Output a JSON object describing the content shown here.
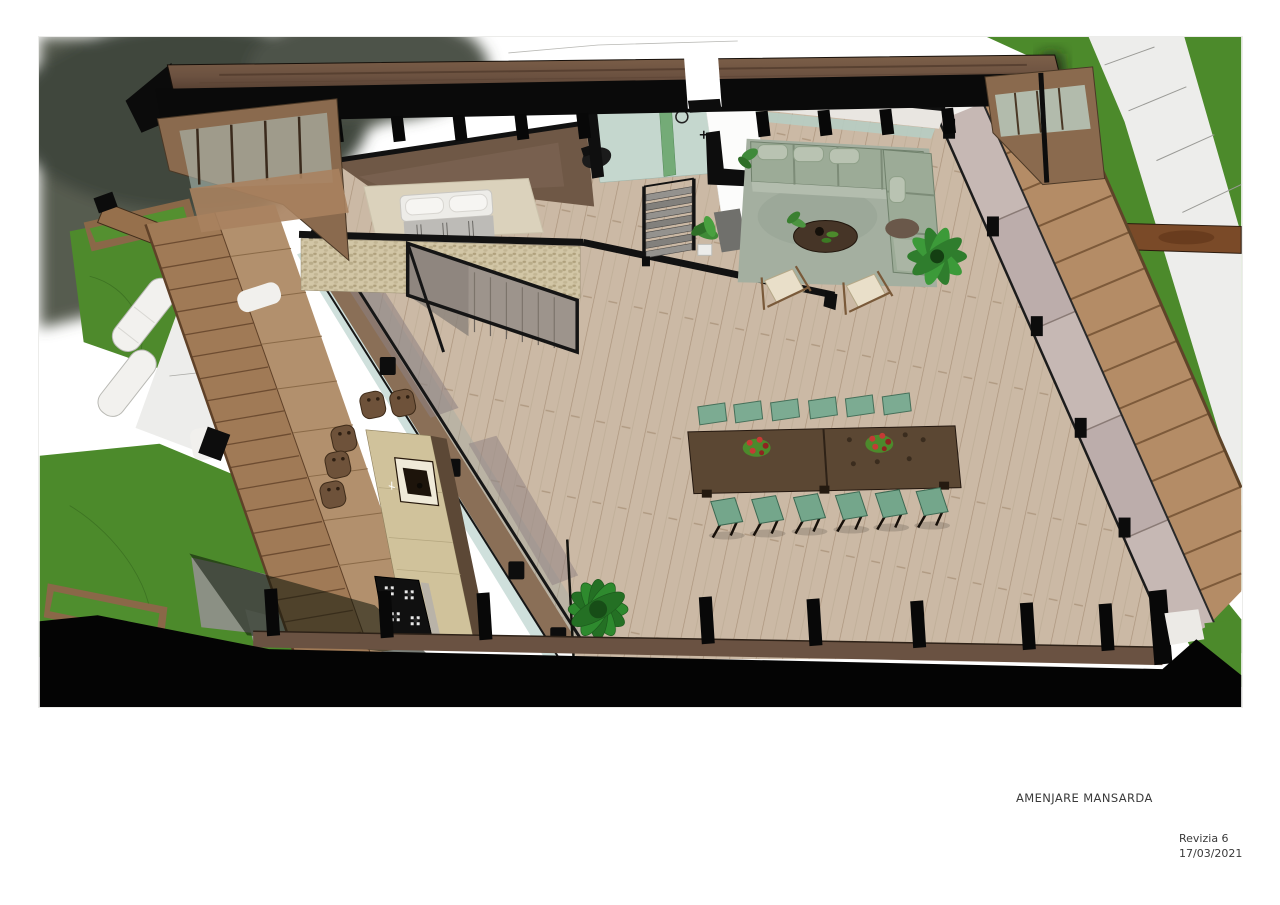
{
  "caption": {
    "title": "AMENJARE MANSARDA"
  },
  "revision": {
    "label": "Revizia 6",
    "date": "17/03/2021"
  },
  "render": {
    "subject": "3d-cutaway-top-view-of-mansard-floor",
    "elements": [
      "roof-section",
      "bedroom",
      "bathroom",
      "staircase",
      "living-room",
      "dining-set",
      "kitchen-island",
      "terrace-deck",
      "garden"
    ],
    "colors": {
      "grass": "#4c8a2b",
      "roof_wood": "#7b5b45",
      "section_cut": "#0a0a0a",
      "floor_wood": "#cbb9a5",
      "sofa_green": "#9cab97",
      "dining_chair_green": "#75a78c",
      "dining_table_wood": "#5b4733",
      "stone_wall": "#cfc3a3",
      "bathroom_teal": "#c3d6cd",
      "deck_wood": "#b48c66",
      "window_glass_mauve": "#c6b8b4"
    }
  }
}
